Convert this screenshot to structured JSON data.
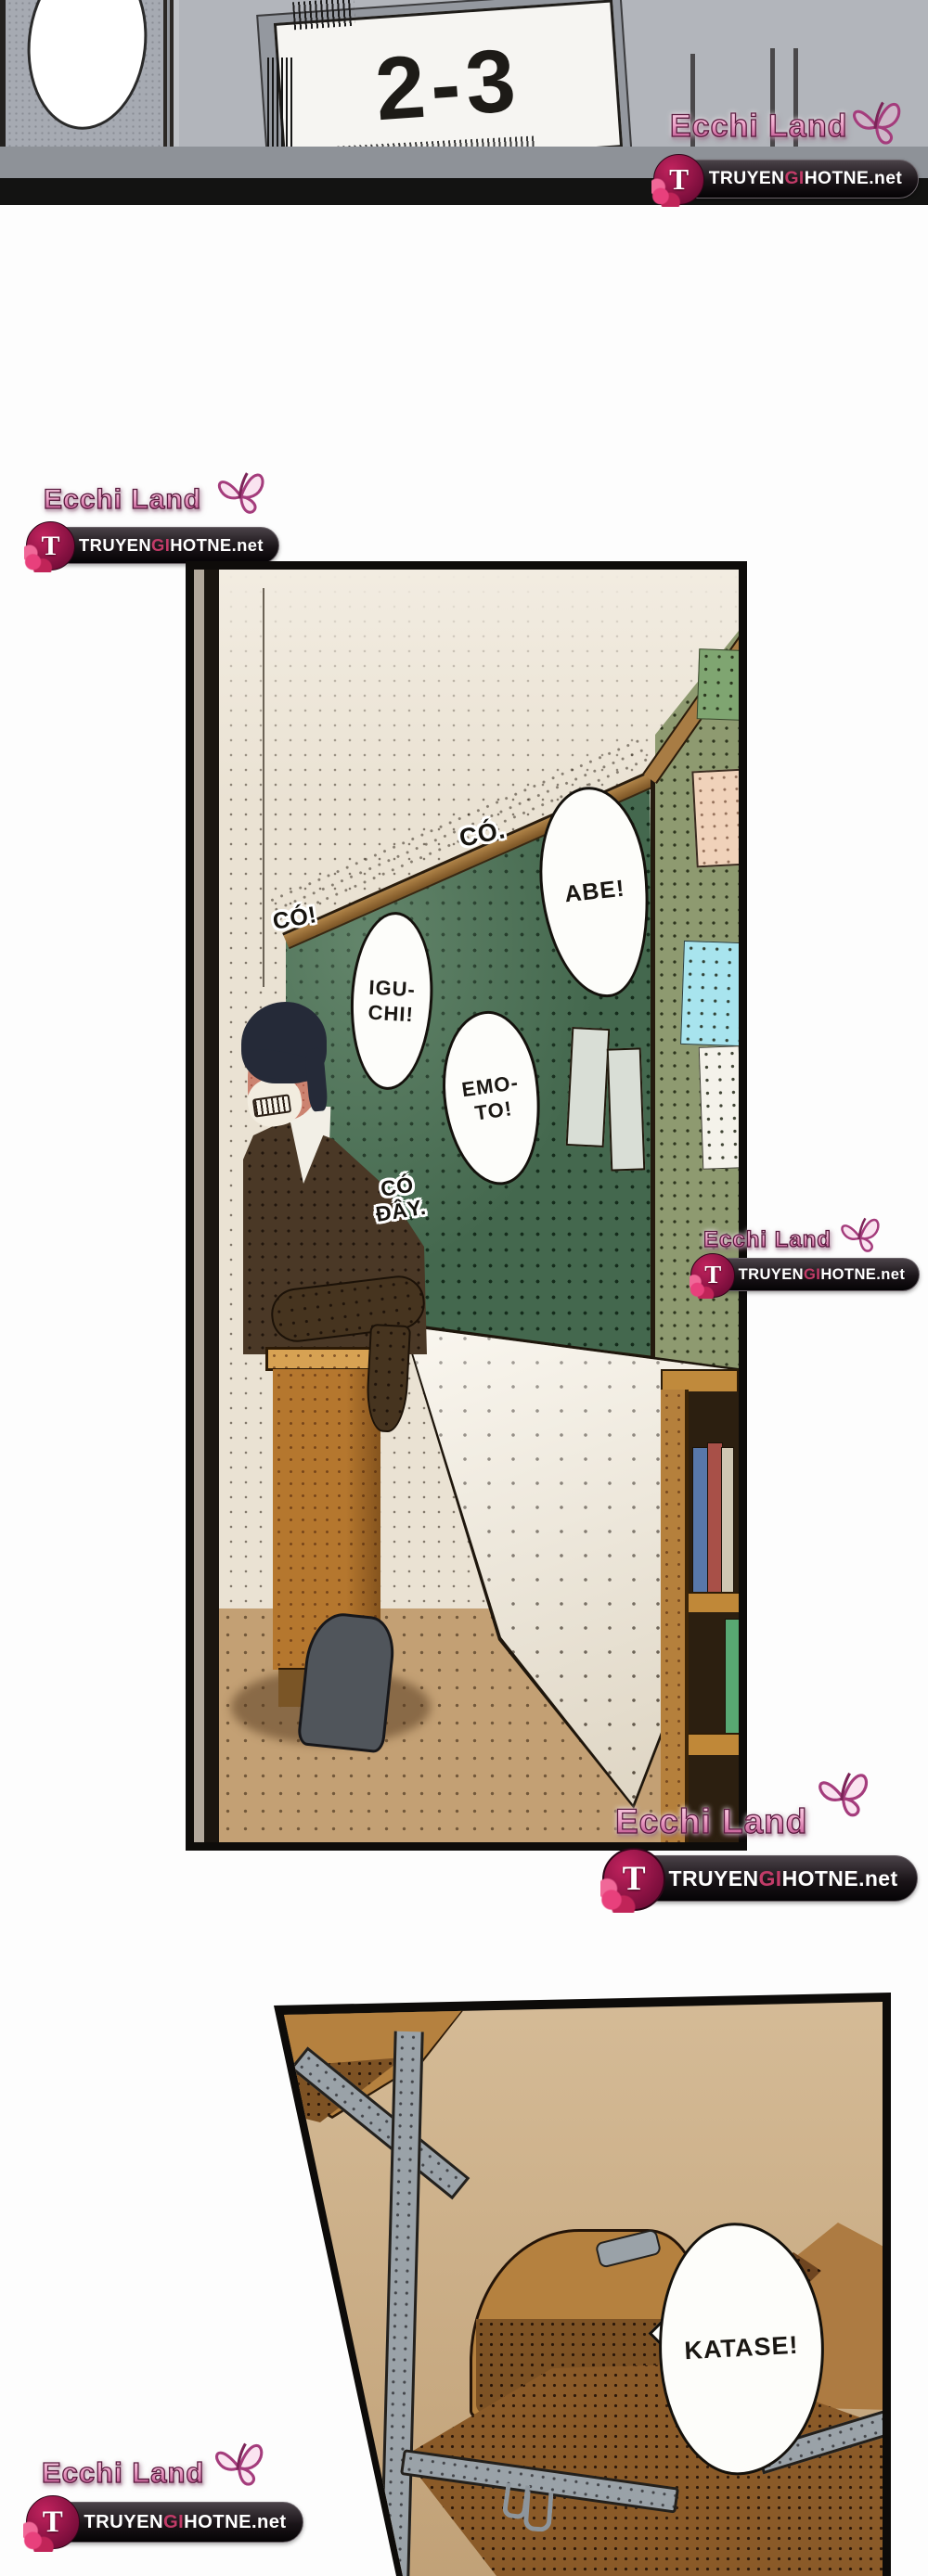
{
  "watermark": {
    "brand": "Ecchi Land",
    "site": {
      "prefix": "TRUYEN",
      "mid": "GI",
      "suffix": "HOTNE",
      "tld": ".net"
    },
    "logo_letter": "T",
    "brand_pink": "#d06ba4",
    "accent": "#c23b68",
    "badge_bg": "#1a1418"
  },
  "top_panel": {
    "door_sign": "2-3"
  },
  "classroom_panel": {
    "texts": {
      "co_dot": "CÓ.",
      "co_excl": "CÓ!",
      "co_day_1": "CÓ",
      "co_day_2": "ĐÂY."
    },
    "bubbles": {
      "abe": "ABE!",
      "igu_1": "IGU-",
      "igu_2": "CHI!",
      "emo_1": "EMO-",
      "emo_2": "TO!"
    },
    "colors": {
      "chalkboard_green": "#44684e",
      "wall_cream": "#eae2d3",
      "side_wall_olive": "#8e9a70",
      "wood_brown": "#b5803c",
      "floor_tan": "#c3a074"
    }
  },
  "desk_panel": {
    "bubbles": {
      "katase": "KATASE!"
    },
    "colors": {
      "wall_tan": "#c7a87e",
      "desk_wood": "#b5813f",
      "metal_gray": "#9aa2a8"
    }
  }
}
